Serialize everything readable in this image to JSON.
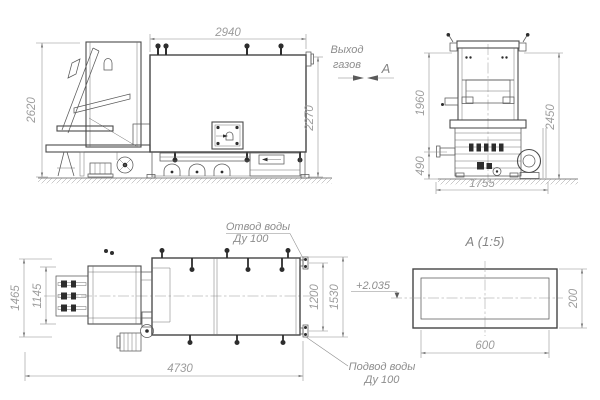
{
  "annotations": {
    "gas_outlet_line1": "Выход",
    "gas_outlet_line2": "газов",
    "view_label": "А",
    "water_outlet_line1": "Отвод воды",
    "water_outlet_line2": "Ду 100",
    "water_supply_line1": "Подвод воды",
    "water_supply_line2": "Ду 100",
    "detail_title": "А (1:5)",
    "elevation_mark": "+2.035"
  },
  "dimensions": {
    "front_width": "2940",
    "front_height_left": "2620",
    "front_height_right": "2270",
    "side_upper_height": "1960",
    "side_total_height": "2450",
    "side_base_height": "490",
    "side_width": "1755",
    "plan_depth_outer": "1465",
    "plan_depth_inner": "1145",
    "plan_length": "4730",
    "plan_port_spacing": "1200",
    "plan_port_span": "1530",
    "duct_width": "600",
    "duct_height": "200"
  },
  "colors": {
    "outline": "#4a4a4a",
    "dimension_lines": "#8a8a8a",
    "dimension_text": "#9c9c9c",
    "background": "#ffffff"
  }
}
